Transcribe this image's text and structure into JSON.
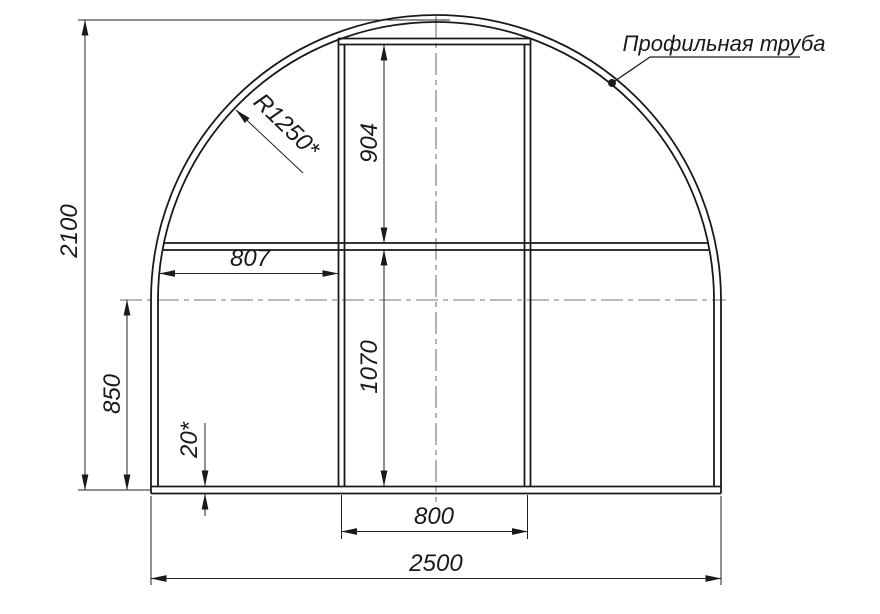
{
  "drawing": {
    "type": "technical-drawing",
    "subject": "greenhouse arch frame cross-section",
    "callout": {
      "label": "Профильная труба"
    },
    "labels": {
      "overall_height": "2100",
      "radius": "R1250*",
      "door_upper_height": "904",
      "arch_to_door_offset": "807",
      "sidewall_height": "850",
      "door_lower_height": "1070",
      "base_tube_thickness": "20*",
      "door_width": "800",
      "overall_width": "2500"
    },
    "colors": {
      "structure_line": "#1a1a1a",
      "dimension_line": "#222222",
      "centerline": "#757575",
      "background": "#ffffff"
    }
  }
}
